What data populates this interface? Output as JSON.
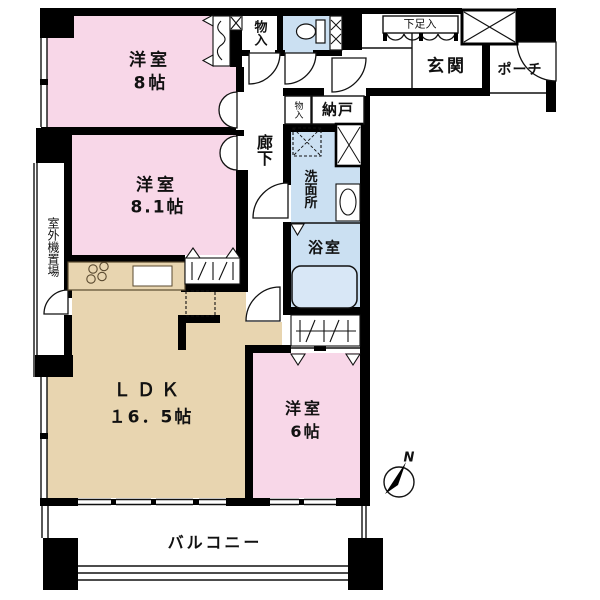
{
  "title": "マンション間取り図",
  "colors": {
    "wall": "#000000",
    "room_pink": "#F8D7E8",
    "room_tan": "#E8D5B0",
    "room_blue": "#CBE0F2",
    "tub_blue": "#D8E7F6",
    "bg": "#FFFFFF"
  },
  "rooms": {
    "bedroom8": {
      "name": "洋室",
      "size": "8帖"
    },
    "bedroom81": {
      "name": "洋室",
      "size": "8.1帖"
    },
    "ldk": {
      "name": "ＬＤＫ",
      "size": "１6．5帖"
    },
    "bedroom6": {
      "name": "洋室",
      "size": "6帖"
    },
    "corridor": {
      "name": "廊下"
    },
    "entrance": {
      "name": "玄関"
    },
    "porch": {
      "name": "ポーチ"
    },
    "shoe_cabinet": {
      "name": "下足入"
    },
    "storeroom": {
      "name": "納戸"
    },
    "closet_top": {
      "name": "物入"
    },
    "closet_small": {
      "name": "物入"
    },
    "washroom": {
      "name": "洗面所"
    },
    "bathroom": {
      "name": "浴室"
    },
    "outdoor_unit": {
      "name": "室外機置場"
    },
    "balcony": {
      "name": "バルコニー"
    }
  },
  "compass": {
    "label": "N"
  }
}
